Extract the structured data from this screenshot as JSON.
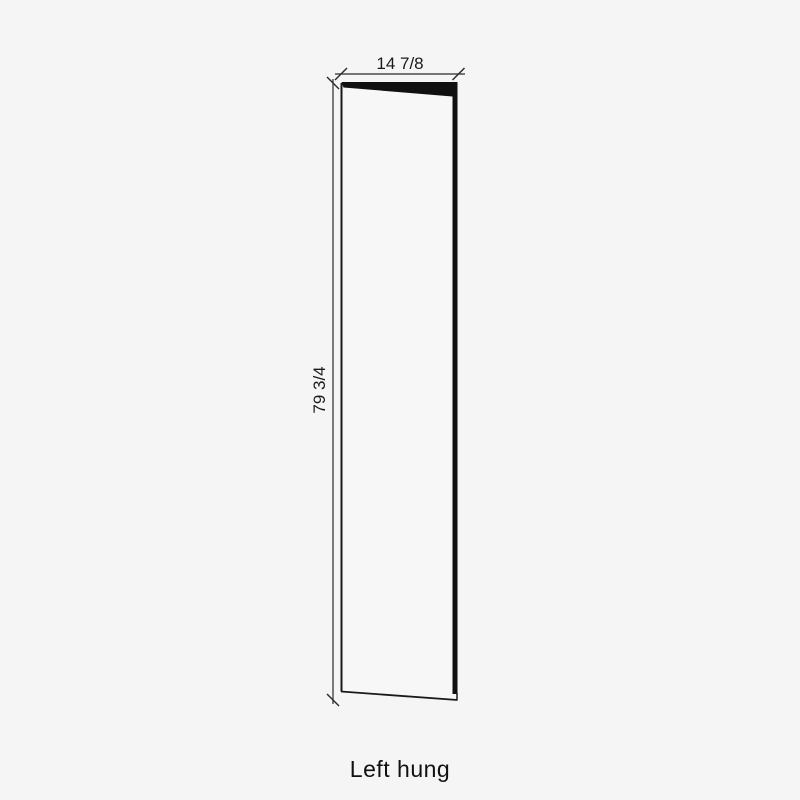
{
  "diagram": {
    "caption": "Left hung",
    "dimensions": {
      "width_label": "14 7/8",
      "height_label": "79 3/4"
    },
    "colors": {
      "background": "#f5f5f5",
      "outline": "#1a1a1a",
      "door_edge_fill": "#101010",
      "dimension_line": "#2a2a2a",
      "text": "#1a1a1a"
    }
  }
}
